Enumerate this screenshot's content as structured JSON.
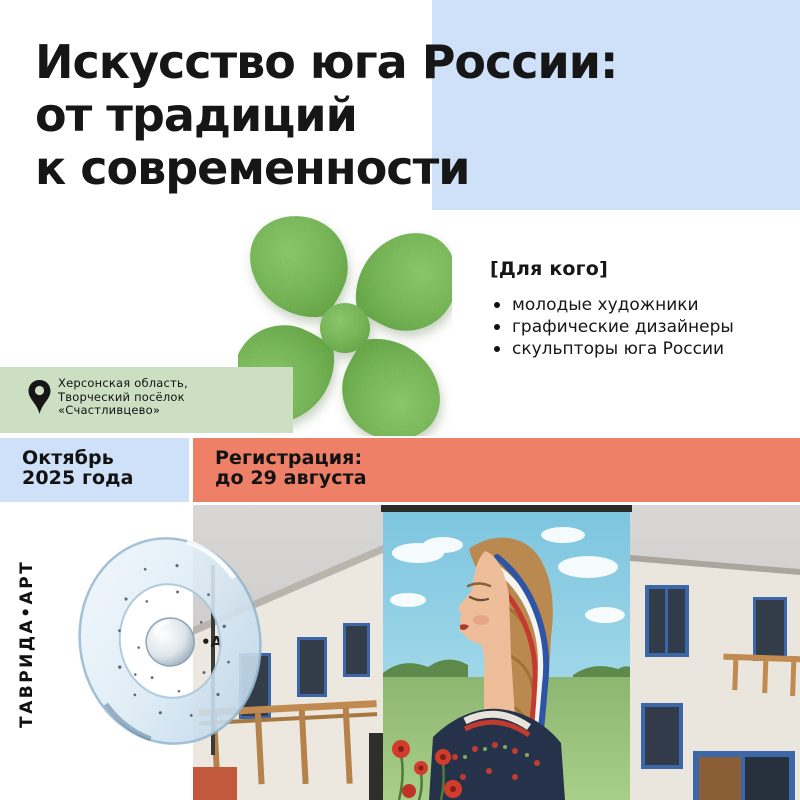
{
  "title": {
    "lines": [
      "Искусство юга России:",
      "от традиций",
      "к современности"
    ]
  },
  "audience": {
    "header": "[Для кого]",
    "items": [
      "молодые художники",
      "графические дизайнеры",
      "скульпторы юга России"
    ]
  },
  "location": {
    "lines": [
      "Херсонская область,",
      "Творческий посёлок",
      "«Счастливцево»"
    ]
  },
  "date_block": {
    "lines": [
      "Октябрь",
      "2025 года"
    ]
  },
  "registration_block": {
    "lines": [
      "Регистрация:",
      "до 29 августа"
    ]
  },
  "brand": {
    "vertical_text": "ТАВРИДА•АРТ",
    "building_sign": "•А"
  },
  "colors": {
    "accent_blue": "#cfe1f8",
    "accent_green": "#ccdfc3",
    "accent_coral": "#ee8067",
    "logo_green": "#79b85a",
    "text_color": "#161616"
  }
}
